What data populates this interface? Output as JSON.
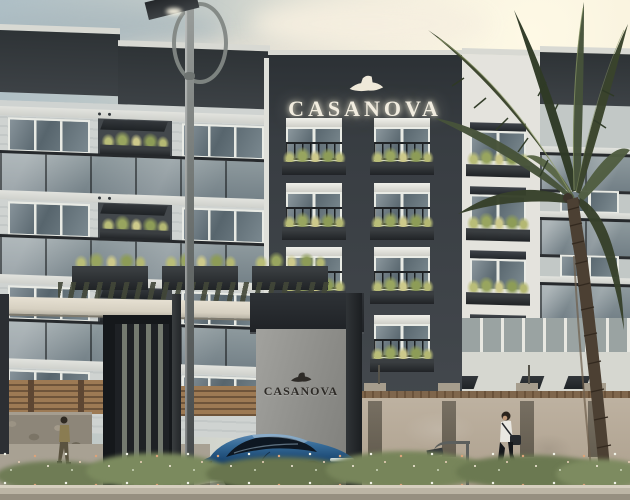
{
  "signs": {
    "main_building": "CASANOVA",
    "entrance_gate": "CASANOVA"
  },
  "icons": {
    "logo": "fedora-hat-icon"
  },
  "colors": {
    "sky_cool": "#aebfc6",
    "sky_warm": "#f2ebd9",
    "tower_facade": "#383d42",
    "wing_facade": "#c9cecd",
    "sign_letters": "#f1ecdf",
    "gate_sign_letters": "#2e2b27",
    "gate_sign_wall": "#949490",
    "boundary_wall": "#b4a795",
    "wood_fence": "#8a6a48",
    "car_blue": "#1d4a75",
    "palm_frond_green": "#3e4830",
    "plant_green": "#a3ae6a",
    "flower_white": "#f0f2e6",
    "flower_coral": "#dba37a",
    "curb": "#bcb5a5"
  }
}
